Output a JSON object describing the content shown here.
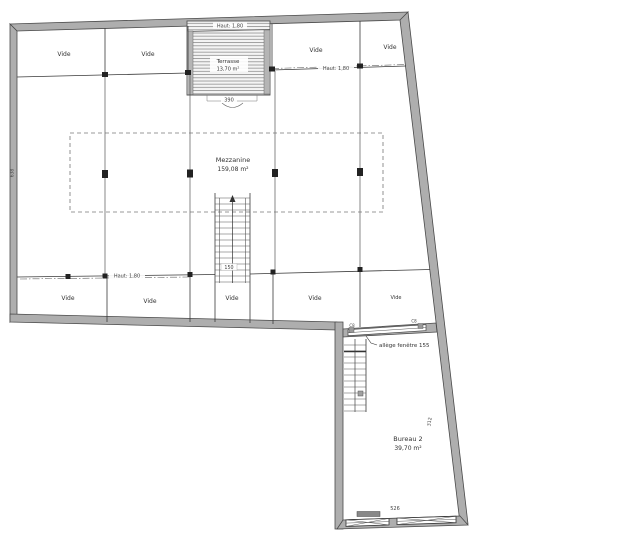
{
  "plan": {
    "rooms": {
      "mezzanine": {
        "name": "Mezzanine",
        "area": "159,08 m²"
      },
      "bureau": {
        "name": "Bureau 2",
        "area": "39,70 m²"
      },
      "terrasse": {
        "name": "Terrasse",
        "area": "13,70 m²"
      }
    },
    "vide_labels": [
      "Vide",
      "Vide",
      "Vide",
      "Vide",
      "Vide",
      "Vide",
      "Vide",
      "Vide",
      "Vide"
    ],
    "annotations": {
      "height_terrace": "Haut: 1,80",
      "height_right": "Haut: 1,80",
      "height_left": "Haut: 1,80",
      "allege": "allège fenêtre 155",
      "stair_note": "150",
      "window_mark_left": "C8",
      "window_mark_right": "C8"
    },
    "dimensions": {
      "terrace_width": "390",
      "bottom_window": "526",
      "right_wall": "312",
      "left_wall": "638"
    },
    "colors": {
      "wall": "#aeaeae",
      "line": "#3a3a3a",
      "text": "#333333"
    }
  }
}
